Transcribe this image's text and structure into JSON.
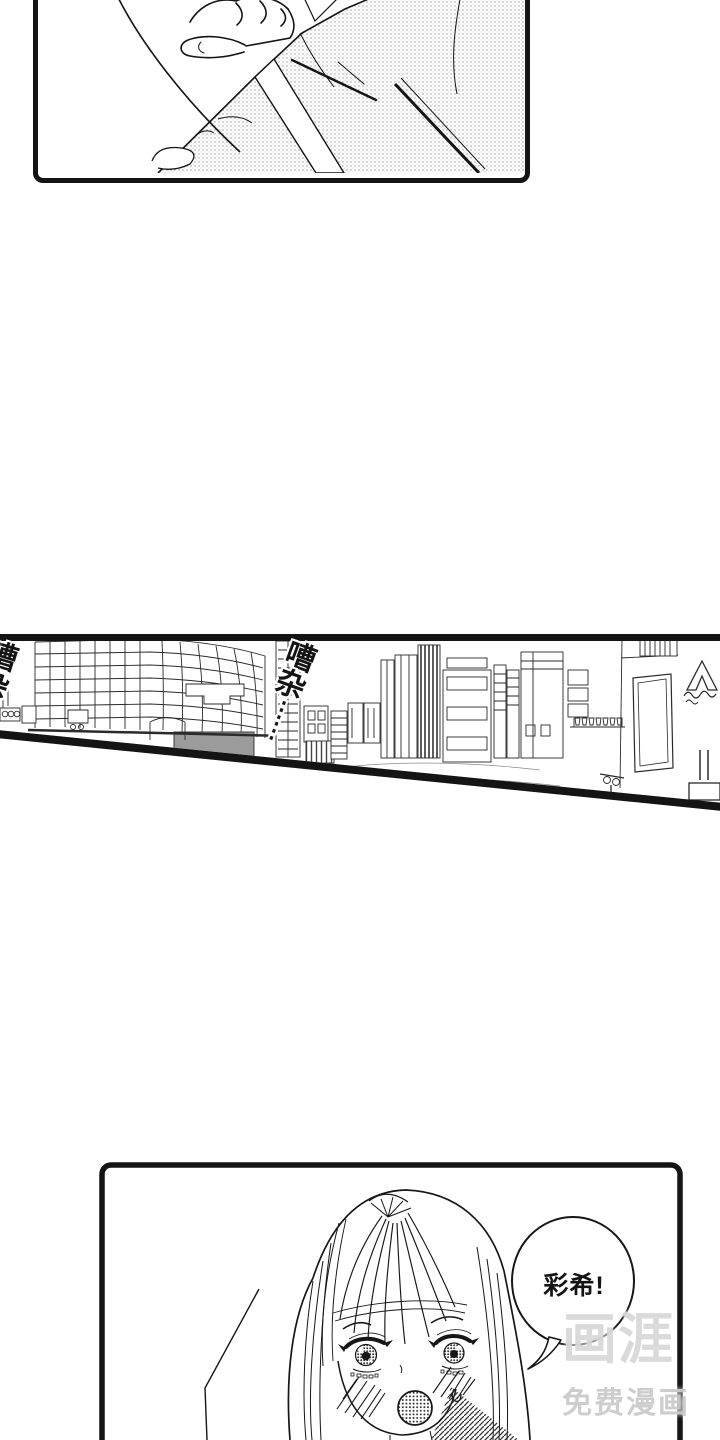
{
  "page": {
    "background": "#ffffff",
    "ink": "#141414"
  },
  "sfx": {
    "first": {
      "char1": "嘈",
      "char2": "杂",
      "dots1": "⋮",
      "dots2": "⋮"
    },
    "second": {
      "char1": "嘈",
      "char2": "杂",
      "dots1": "⋮",
      "dots2": "⋮"
    }
  },
  "speech_bubble": {
    "text": "彩希!"
  },
  "watermark": {
    "logo": "画涯",
    "tagline": "免费漫画",
    "logo_color": "#d9d9d9",
    "tagline_color": "#cbcbcb"
  }
}
